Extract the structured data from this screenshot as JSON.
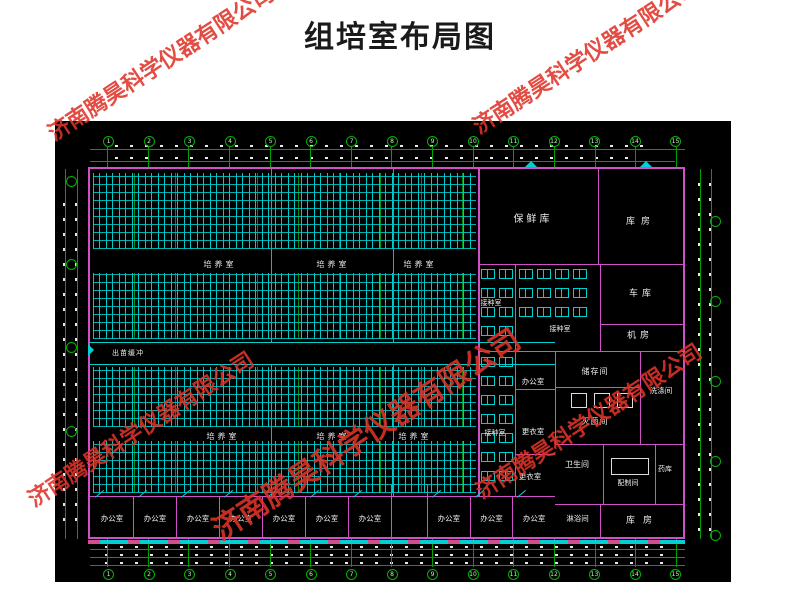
{
  "title": "组培室布局图",
  "watermark": {
    "text": "济南腾昊科学仪器有限公司",
    "color": "#e03428"
  },
  "plan": {
    "rooms": {
      "culture_room": "培养室",
      "inoculation_room": "接种室",
      "seedling_buffer": "出苗缓冲",
      "fresh_keeping_store": "保鲜库",
      "storehouse": "库房",
      "garage": "车库",
      "machine_room": "机房",
      "office": "办公室",
      "locker_room": "更衣室",
      "storage_room": "储存间",
      "sterilizing_room": "灭菌间",
      "washing_room": "洗涤间",
      "toilet": "卫生间",
      "media_prep_room": "配制间",
      "chemical_store": "药库",
      "shower_room": "淋浴间"
    },
    "grid_columns": [
      "1",
      "2",
      "3",
      "4",
      "5",
      "6",
      "7",
      "8",
      "9",
      "10",
      "11",
      "12",
      "13",
      "14",
      "15"
    ],
    "colors": {
      "canvas": "#000000",
      "wall": "#d050c8",
      "fixture_cyan": "#00d0d0",
      "grid_green": "#00a000",
      "label_text": "#ececec"
    }
  }
}
